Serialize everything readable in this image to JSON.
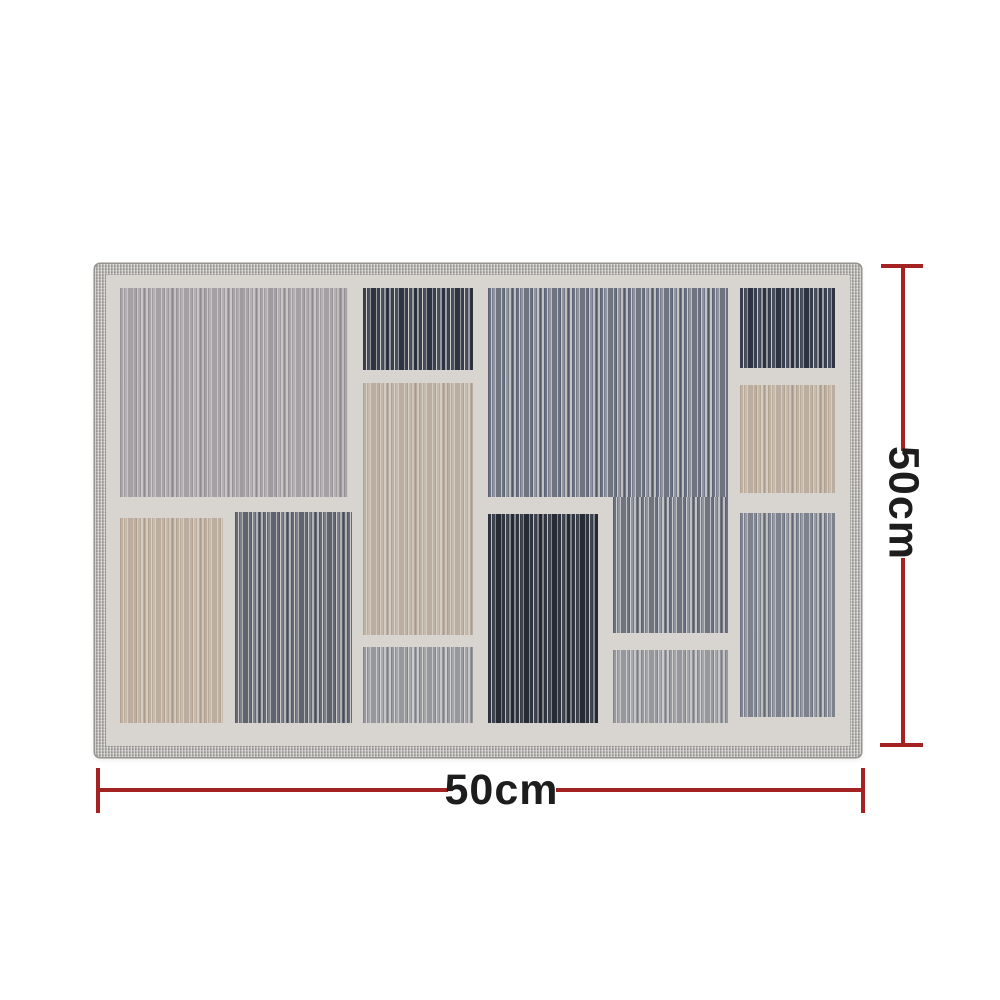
{
  "dimension_annotations": {
    "width": {
      "label": "50cm"
    },
    "height": {
      "label": "50cm"
    },
    "line_color": "#a52222",
    "label_color": "#1d1d1e"
  },
  "rug": {
    "field_color": "#d8d5d1",
    "edge_color": "#b3b0ad",
    "edge_stitch_color": "#96938f",
    "stripe_styles": {
      "light_taupe": {
        "bg": "rgba(175,171,175,0.35)",
        "s1": "rgba(140,135,142,0.55)",
        "s2": "rgba(158,153,159,0.50)",
        "s3": "rgba(118,113,122,0.45)",
        "hl": "rgba(210,207,208,0.60)",
        "wash": "rgba(150,146,151,0.18)"
      },
      "beige": {
        "bg": "rgba(205,193,178,0.35)",
        "s1": "rgba(170,150,128,0.50)",
        "s2": "rgba(188,172,152,0.55)",
        "s3": "rgba(150,128,104,0.40)",
        "hl": "rgba(216,209,199,0.60)",
        "wash": "rgba(170,150,128,0.15)"
      },
      "dark_navy": {
        "bg": "rgba(82,89,103,0.50)",
        "s1": "rgba(52,59,74,0.95)",
        "s2": "rgba(66,73,88,0.90)",
        "s3": "rgba(40,46,60,0.95)",
        "hl": "rgba(213,210,206,0.90)",
        "wash": "rgba(255,255,255,0.06)"
      },
      "slate_medium": {
        "bg": "rgba(165,168,177,0.50)",
        "s1": "rgba(86,94,112,0.80)",
        "s2": "rgba(120,126,140,0.65)",
        "s3": "rgba(70,77,92,0.65)",
        "hl": "rgba(205,207,212,0.80)",
        "wash": "rgba(255,255,255,0.08)"
      },
      "charcoal": {
        "bg": "rgba(66,71,82,0.55)",
        "s1": "rgba(44,49,60,0.95)",
        "s2": "rgba(56,62,74,0.90)",
        "s3": "rgba(33,38,48,0.95)",
        "hl": "rgba(210,207,203,0.80)",
        "wash": "rgba(0,0,0,0.05)"
      },
      "slate_grey": {
        "bg": "rgba(120,126,138,0.40)",
        "s1": "rgba(80,87,101,0.80)",
        "s2": "rgba(100,106,119,0.70)",
        "s3": "rgba(60,67,82,0.70)",
        "hl": "rgba(214,211,207,0.80)",
        "wash": "rgba(255,255,255,0.07)"
      },
      "grey_washed": {
        "bg": "rgba(160,164,172,0.30)",
        "s1": "rgba(110,116,128,0.55)",
        "s2": "rgba(130,135,146,0.50)",
        "s3": "rgba(90,96,110,0.45)",
        "hl": "rgba(218,215,212,0.70)",
        "wash": "rgba(255,255,255,0.10)"
      },
      "grey_blue": {
        "bg": "rgba(140,145,156,0.35)",
        "s1": "rgba(98,105,120,0.65)",
        "s2": "rgba(120,126,139,0.55)",
        "s3": "rgba(75,82,98,0.55)",
        "hl": "rgba(216,213,209,0.70)",
        "wash": "rgba(255,255,255,0.08)"
      }
    },
    "panels": [
      {
        "name": "top-left-light",
        "style": "light_taupe",
        "x": 14,
        "y": 13,
        "w": 228,
        "h": 209
      },
      {
        "name": "upper-mid-dark",
        "style": "dark_navy",
        "x": 257,
        "y": 13,
        "w": 110,
        "h": 82
      },
      {
        "name": "mid-beige",
        "style": "beige",
        "x": 257,
        "y": 108,
        "w": 110,
        "h": 252
      },
      {
        "name": "lower-mid-grey",
        "style": "grey_washed",
        "x": 257,
        "y": 372,
        "w": 110,
        "h": 76
      },
      {
        "name": "center-slate-main",
        "style": "slate_medium",
        "x": 382,
        "y": 13,
        "w": 240,
        "h": 209
      },
      {
        "name": "center-slate-extension",
        "style": "slate_medium",
        "x": 507,
        "y": 222,
        "w": 115,
        "h": 136
      },
      {
        "name": "center-charcoal",
        "style": "charcoal",
        "x": 382,
        "y": 239,
        "w": 110,
        "h": 209
      },
      {
        "name": "lower-center-grey",
        "style": "grey_washed",
        "x": 507,
        "y": 375,
        "w": 115,
        "h": 73
      },
      {
        "name": "top-right-dark",
        "style": "dark_navy",
        "x": 634,
        "y": 13,
        "w": 95,
        "h": 80
      },
      {
        "name": "right-beige",
        "style": "beige",
        "x": 634,
        "y": 110,
        "w": 95,
        "h": 108
      },
      {
        "name": "lower-right-grey",
        "style": "grey_blue",
        "x": 634,
        "y": 238,
        "w": 95,
        "h": 204
      },
      {
        "name": "bottom-left-beige",
        "style": "beige",
        "x": 14,
        "y": 243,
        "w": 103,
        "h": 205
      },
      {
        "name": "bottom-left-slate",
        "style": "slate_grey",
        "x": 129,
        "y": 237,
        "w": 117,
        "h": 211
      }
    ]
  }
}
